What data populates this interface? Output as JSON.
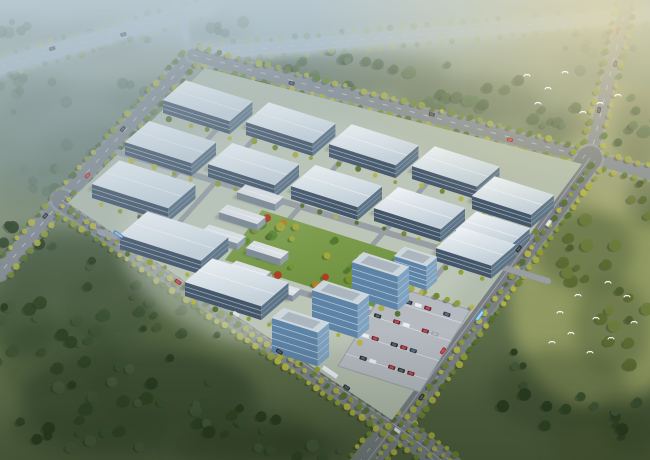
{
  "scene": {
    "title": "Aerial rendering of an industrial park campus",
    "description": "Bird's-eye architectural rendering of a diamond-shaped industrial park with rows of white factory warehouses, a central landscaped garden with autumn trees, blue-glass office slabs beside a car park, tree-lined boulevards with traffic, surrounding dark forest, white birds over the woods and a hazy blue horizon",
    "width": 650,
    "height": 460
  },
  "palette": {
    "roof_light": "#f2f6f8",
    "roof_dark": "#c3d0d9",
    "glass_front": "#44566a",
    "glass_side": "#5d7386",
    "glass_stripe": "#cdd9e2",
    "office_front": "#5d83a6",
    "office_side": "#7fa2c0",
    "office_stripe": "#e8eef3",
    "office_roof": "#ccd6dd",
    "office_roof_inner": "#a7b3bb",
    "shed_roof": "#dce2e6",
    "shed_front": "#7d8a96",
    "shed_side": "#929ea9",
    "road": "#82898f",
    "sidewalk": "#9fa6aa",
    "road_mark": "#ffffff",
    "campus_ground": "#b2bdae",
    "park_green_a": "#86a452",
    "park_green_b": "#6c9040",
    "tree_shadow": "#1e2b18",
    "bird_white": "#ffffff",
    "haze_top": "#bdcdd6",
    "haze_warm": "#f0dfa6",
    "haze_mist": "#a0b4c2",
    "vignette": "#101c0e"
  },
  "ground": {
    "patches": [
      [
        325,
        25,
        420,
        60,
        "#9fb3b8",
        0.9
      ],
      [
        80,
        140,
        200,
        110,
        "#76887b",
        0.8
      ],
      [
        70,
        300,
        180,
        130,
        "#55664a",
        0.9
      ],
      [
        140,
        400,
        240,
        110,
        "#45553b",
        0.95
      ],
      [
        250,
        445,
        160,
        40,
        "#3f4e35",
        0.9
      ],
      [
        600,
        300,
        180,
        220,
        "#99a166",
        0.85
      ],
      [
        625,
        150,
        120,
        130,
        "#a7ab7c",
        0.8
      ],
      [
        610,
        440,
        120,
        60,
        "#4c5a36",
        0.8
      ],
      [
        330,
        240,
        260,
        170,
        "#b7c2b2",
        0.8
      ]
    ]
  },
  "tree_palettes": {
    "mist": [
      "#5e7360",
      "#53684f",
      "#6a7f68"
    ],
    "mid": [
      "#4c6340",
      "#57704a",
      "#425938"
    ],
    "dark": [
      "#2f4424",
      "#3a5130",
      "#283c20",
      "#44593a"
    ],
    "warm": [
      "#4d5f2d",
      "#5c6c31",
      "#6d7c3c"
    ],
    "street": [
      "#a8ad3c",
      "#8f9c34",
      "#6f8530",
      "#b5b441",
      "#55702c"
    ],
    "park": [
      "#4f7a2c",
      "#79952f",
      "#a5a93a",
      "#c07a22",
      "#b23c20",
      "#5c8a33"
    ]
  },
  "forest": {
    "clusters": [
      [
        25,
        90,
        50,
        25,
        9,
        "mist"
      ],
      [
        95,
        150,
        60,
        30,
        11,
        "mist"
      ],
      [
        40,
        185,
        55,
        28,
        9,
        "mist"
      ],
      [
        150,
        95,
        45,
        20,
        7,
        "mist"
      ],
      [
        90,
        40,
        60,
        18,
        7,
        "mist"
      ],
      [
        215,
        30,
        40,
        14,
        5,
        "mist"
      ],
      [
        15,
        30,
        30,
        15,
        5,
        "mist"
      ],
      [
        260,
        75,
        55,
        18,
        9,
        "mid"
      ],
      [
        350,
        72,
        110,
        26,
        16,
        "mid"
      ],
      [
        470,
        100,
        80,
        26,
        13,
        "mid"
      ],
      [
        560,
        125,
        40,
        18,
        7,
        "mid"
      ],
      [
        598,
        55,
        45,
        30,
        8,
        "mist"
      ],
      [
        638,
        130,
        28,
        45,
        7,
        "mid"
      ],
      [
        60,
        260,
        70,
        40,
        12,
        "dark"
      ],
      [
        140,
        310,
        90,
        45,
        16,
        "dark"
      ],
      [
        60,
        360,
        70,
        45,
        12,
        "dark"
      ],
      [
        170,
        390,
        90,
        40,
        14,
        "dark"
      ],
      [
        90,
        430,
        90,
        30,
        12,
        "dark"
      ],
      [
        250,
        430,
        70,
        25,
        10,
        "dark"
      ],
      [
        20,
        320,
        40,
        40,
        8,
        "dark"
      ],
      [
        310,
        448,
        50,
        15,
        5,
        "dark"
      ],
      [
        585,
        250,
        55,
        45,
        11,
        "warm"
      ],
      [
        612,
        325,
        42,
        55,
        10,
        "warm"
      ],
      [
        558,
        390,
        75,
        45,
        12,
        "dark"
      ],
      [
        630,
        420,
        35,
        35,
        7,
        "dark"
      ],
      [
        648,
        200,
        25,
        30,
        5,
        "warm"
      ]
    ]
  },
  "roads": [
    {
      "id": "highway-northwest",
      "pts": [
        [
          -12,
          70
        ],
        [
          205,
          8
        ]
      ],
      "w": 15,
      "col": "#9fb0ba",
      "haze": 0.45,
      "trees": [
        -10,
        10
      ],
      "sp": 12,
      "top": 0.5,
      "dash": true
    },
    {
      "id": "highway-northeast",
      "pts": [
        [
          193,
          55
        ],
        [
          650,
          14
        ]
      ],
      "w": 13,
      "col": "#9fb0ba",
      "haze": 0.4,
      "trees": [
        -9,
        9
      ],
      "sp": 12,
      "top": 0.5,
      "dash": true
    },
    {
      "id": "spur-north",
      "pts": [
        [
          186,
          38
        ],
        [
          175,
          0
        ]
      ],
      "w": 6,
      "col": "#9fb0ba",
      "haze": 0.4
    },
    {
      "id": "road-northwest",
      "pts": [
        [
          193,
          55
        ],
        [
          62,
          200
        ],
        [
          0,
          273
        ]
      ],
      "w": 13,
      "col": "#82898f",
      "trees": [
        -9,
        9
      ],
      "sp": 10,
      "top": 0.9,
      "dash": true
    },
    {
      "id": "road-north",
      "pts": [
        [
          193,
          55
        ],
        [
          590,
          158
        ]
      ],
      "w": 12,
      "col": "#82898f",
      "trees": [
        -8.5,
        8.5
      ],
      "sp": 10,
      "top": 0.9,
      "dash": true
    },
    {
      "id": "road-east-north",
      "pts": [
        [
          590,
          158
        ],
        [
          628,
          0
        ]
      ],
      "w": 13,
      "col": "#868d93",
      "trees": [
        -9,
        9
      ],
      "sp": 10,
      "top": 0.85,
      "dash": true
    },
    {
      "id": "road-east-arm",
      "pts": [
        [
          590,
          158
        ],
        [
          652,
          174
        ]
      ],
      "w": 12,
      "col": "#868d93",
      "trees": [
        -8,
        8
      ],
      "sp": 10,
      "top": 0.8
    },
    {
      "id": "boulevard-southeast",
      "pts": [
        [
          590,
          158
        ],
        [
          395,
          425
        ],
        [
          362,
          468
        ]
      ],
      "w": 24,
      "col": "#797f85",
      "trees": [
        -16,
        -6,
        16
      ],
      "sp": 9,
      "top": 0.95,
      "dash": true
    },
    {
      "id": "boulevard-front",
      "pts": [
        [
          62,
          200
        ],
        [
          395,
          425
        ],
        [
          452,
          468
        ]
      ],
      "w": 20,
      "col": "#7b8287",
      "trees": [
        -13,
        -4.5,
        4.5,
        13
      ],
      "sp": 9,
      "top": 0.95,
      "dash": true
    }
  ],
  "campus": {
    "boundary": [
      [
        205,
        68
      ],
      [
        582,
        164
      ],
      [
        392,
        420
      ],
      [
        68,
        203
      ]
    ],
    "axes": {
      "u": [
        0.953,
        0.301
      ],
      "v": [
        0.758,
        -0.652
      ]
    },
    "internal_roads": [
      {
        "pts": [
          [
            118,
            152
          ],
          [
            548,
            281
          ]
        ],
        "w": 6
      },
      {
        "pts": [
          [
            100,
            232
          ],
          [
            430,
            331
          ]
        ],
        "w": 6
      },
      {
        "pts": [
          [
            262,
            130
          ],
          [
            168,
            235
          ]
        ],
        "w": 5
      },
      {
        "pts": [
          [
            345,
            156
          ],
          [
            255,
            258
          ]
        ],
        "w": 5
      },
      {
        "pts": [
          [
            428,
            182
          ],
          [
            338,
            284
          ]
        ],
        "w": 5
      },
      {
        "pts": [
          [
            500,
            204
          ],
          [
            415,
            300
          ]
        ],
        "w": 5
      },
      {
        "pts": [
          [
            236,
            108
          ],
          [
            140,
            214
          ]
        ],
        "w": 5
      }
    ],
    "park": {
      "poly": [
        [
          262,
          210
        ],
        [
          414,
          258
        ],
        [
          377,
          308
        ],
        [
          225,
          260
        ]
      ],
      "tree_count": 26
    },
    "warehouses": [
      [
        163,
        100,
        70,
        30,
        13
      ],
      [
        246,
        122,
        70,
        30,
        13
      ],
      [
        329,
        144,
        70,
        30,
        13
      ],
      [
        412,
        166,
        68,
        30,
        13
      ],
      [
        125,
        142,
        70,
        32,
        13
      ],
      [
        208,
        164,
        70,
        32,
        13
      ],
      [
        291,
        186,
        70,
        32,
        13
      ],
      [
        374,
        208,
        70,
        32,
        13
      ],
      [
        455,
        230,
        56,
        28,
        12
      ],
      [
        92,
        184,
        80,
        36,
        14
      ],
      [
        120,
        235,
        85,
        36,
        14
      ],
      [
        185,
        282,
        80,
        36,
        14
      ],
      [
        436,
        248,
        58,
        32,
        13
      ],
      [
        472,
        196,
        62,
        30,
        13
      ]
    ],
    "sheds": [
      [
        237,
        192,
        40,
        11,
        7
      ],
      [
        219,
        212,
        40,
        11,
        7
      ],
      [
        201,
        232,
        38,
        11,
        7
      ],
      [
        246,
        248,
        36,
        11,
        7
      ],
      [
        228,
        268,
        36,
        11,
        7
      ],
      [
        262,
        286,
        32,
        10,
        6
      ]
    ],
    "offices": [
      [
        352,
        262,
        48,
        15,
        34
      ],
      [
        312,
        290,
        48,
        15,
        34
      ],
      [
        272,
        318,
        48,
        15,
        34
      ],
      [
        394,
        256,
        34,
        14,
        24
      ]
    ],
    "parking": {
      "poly": [
        [
          388,
          284
        ],
        [
          470,
          310
        ],
        [
          420,
          392
        ],
        [
          338,
          366
        ]
      ],
      "stall_rows": [
        0.16,
        0.38,
        0.62,
        0.85
      ],
      "car_rows": [
        {
          "f": 0.12,
          "cars": [
            null,
            "#7b1f2b",
            "#242b33",
            "#e6e9eb",
            "#7b1f2b",
            null,
            "#2c3a4d"
          ]
        },
        {
          "f": 0.36,
          "cars": [
            "#242b33",
            null,
            "#7b1f2b",
            "#e6e9eb",
            null,
            "#7b1f2b",
            "#99a2ab"
          ]
        },
        {
          "f": 0.6,
          "cars": [
            "#e6e9eb",
            "#7b1f2b",
            null,
            "#242b33",
            "#7b1f2b",
            "#2c3a4d",
            null
          ]
        },
        {
          "f": 0.84,
          "cars": [
            null,
            "#242b33",
            "#e6e9eb",
            null,
            "#7b1f2b",
            "#242b33",
            "#7b1f2b"
          ]
        }
      ]
    },
    "gate": {
      "x": 330,
      "y": 372,
      "len": 18,
      "wid": 5
    }
  },
  "vehicles": [
    {
      "road": "boulevard-front",
      "t": 0.14,
      "o": -3,
      "c": "#2e6fc4",
      "len": 11
    },
    {
      "road": "boulevard-front",
      "t": 0.3,
      "o": 3,
      "c": "#b02020",
      "len": 7
    },
    {
      "road": "boulevard-front",
      "t": 0.44,
      "o": -3,
      "c": "#d8dde1",
      "len": 7
    },
    {
      "road": "boulevard-front",
      "t": 0.56,
      "o": 4,
      "c": "#1f262e",
      "len": 7
    },
    {
      "road": "boulevard-front",
      "t": 0.72,
      "o": -4,
      "c": "#1f262e",
      "len": 7
    },
    {
      "road": "boulevard-front",
      "t": 0.86,
      "o": 3,
      "c": "#d8dde1",
      "len": 7
    },
    {
      "road": "boulevard-southeast",
      "t": 0.5,
      "o": -4,
      "c": "#34a3d8",
      "len": 12
    },
    {
      "road": "boulevard-southeast",
      "t": 0.3,
      "o": 4,
      "c": "#1f262e",
      "len": 7
    },
    {
      "road": "boulevard-southeast",
      "t": 0.2,
      "o": -5,
      "c": "#d8dde1",
      "len": 7
    },
    {
      "road": "boulevard-southeast",
      "t": 0.63,
      "o": 5,
      "c": "#b02020",
      "len": 7
    },
    {
      "road": "boulevard-southeast",
      "t": 0.76,
      "o": -5,
      "c": "#1f262e",
      "len": 7
    },
    {
      "road": "road-east-north",
      "t": 0.3,
      "o": -2.5,
      "c": "#1f262e",
      "len": 6
    },
    {
      "road": "road-east-north",
      "t": 0.6,
      "o": 2.5,
      "c": "#1f262e",
      "len": 6
    },
    {
      "road": "road-east-north",
      "t": 0.8,
      "o": -2.5,
      "c": "#b02020",
      "len": 6
    },
    {
      "road": "road-northwest",
      "t": 0.35,
      "o": 2.5,
      "c": "#1f262e",
      "len": 6
    },
    {
      "road": "road-northwest",
      "t": 0.55,
      "o": -2.5,
      "c": "#b02020",
      "len": 6
    },
    {
      "road": "road-northwest",
      "t": 0.75,
      "o": 2.5,
      "c": "#1f262e",
      "len": 6
    },
    {
      "road": "road-north",
      "t": 0.25,
      "o": 2.5,
      "c": "#1f262e",
      "len": 6
    },
    {
      "road": "road-north",
      "t": 0.6,
      "o": -2.5,
      "c": "#23292f",
      "len": 6
    },
    {
      "road": "road-north",
      "t": 0.8,
      "o": 2.5,
      "c": "#b02020",
      "len": 6
    },
    {
      "road": "highway-northwest",
      "t": 0.3,
      "o": -3,
      "c": "#2a3138",
      "len": 6
    },
    {
      "road": "highway-northwest",
      "t": 0.62,
      "o": 3,
      "c": "#2a3138",
      "len": 6
    }
  ],
  "birds": [
    [
      618,
      95
    ],
    [
      600,
      103
    ],
    [
      583,
      112
    ],
    [
      608,
      282
    ],
    [
      578,
      295
    ],
    [
      627,
      296
    ],
    [
      560,
      312
    ],
    [
      596,
      318
    ],
    [
      634,
      322
    ],
    [
      571,
      333
    ],
    [
      611,
      338
    ],
    [
      590,
      352
    ],
    [
      552,
      342
    ],
    [
      527,
      75
    ],
    [
      548,
      88
    ],
    [
      565,
      72
    ],
    [
      538,
      103
    ]
  ]
}
